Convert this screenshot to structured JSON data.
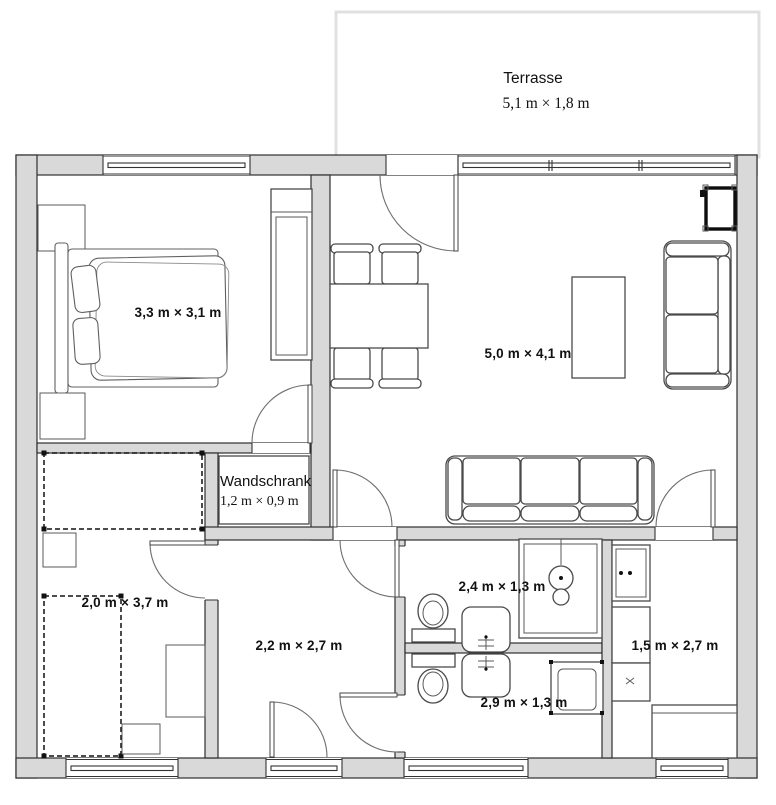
{
  "title": "Grundriss Wohnung",
  "terrace": {
    "name": "Terrasse",
    "dims": "5,1 m × 1,8 m"
  },
  "rooms": {
    "bedroom": {
      "dims": "3,3 m × 3,1 m"
    },
    "living": {
      "dims": "5,0 m × 4,1 m"
    },
    "closet": {
      "name": "Wandschrank",
      "dims": "1,2 m × 0,9 m"
    },
    "room_small": {
      "dims": "2,0 m × 3,7 m"
    },
    "hallway": {
      "dims": "2,2 m × 2,7 m"
    },
    "bath": {
      "dims": "2,4 m × 1,3 m"
    },
    "bath2": {
      "dims": "2,9 m × 1,3 m"
    },
    "kitchen": {
      "dims": "1,5 m × 2,7 m"
    }
  },
  "colors": {
    "wall_fill": "#d9d9d9",
    "wall_stroke": "#2e2e2e",
    "furniture": "#4a4a4a",
    "terrace_border": "#e0e0e0",
    "text": "#111111"
  }
}
